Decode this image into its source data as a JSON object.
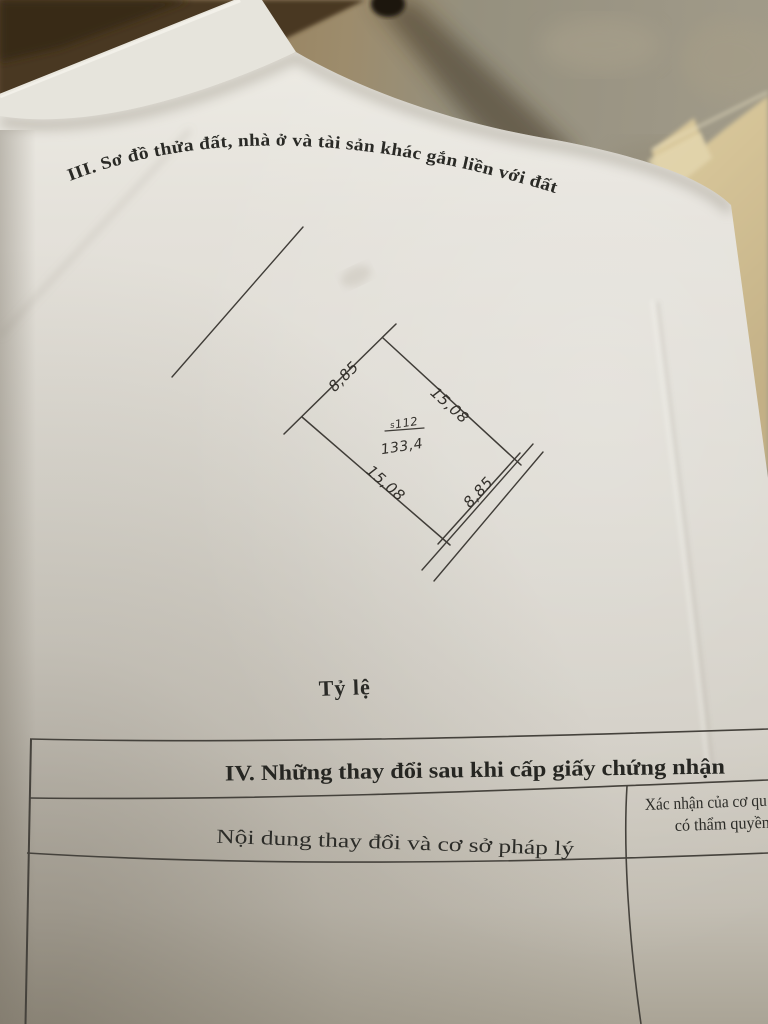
{
  "colors": {
    "ink": "#2a2a26",
    "pen_line": "#403d38",
    "paper": "#dcd9d1",
    "folder_tan": "#97825f",
    "wood_brown": "#4a3722",
    "loose_paper_cream": "#d5c49a"
  },
  "page": {
    "section_iii_heading": "III. Sơ đồ thửa đất, nhà ở và tài sản khác gắn liền với đất",
    "diagram": {
      "parcel_mark": "s",
      "parcel_number": "112",
      "area": "133,4",
      "side_top_left": "8,85",
      "side_top_right": "15,08",
      "side_bottom_left": "15,08",
      "side_bottom_right": "8,85"
    },
    "scale_label": "Tỷ lệ",
    "section_iv": {
      "heading": "IV. Những thay đổi sau khi cấp giấy chứng nhận",
      "left_column_header": "Nội dung thay đổi và cơ sở pháp lý",
      "right_column_header_line1": "Xác nhận của cơ qu",
      "right_column_header_line2": "có thẩm quyền"
    }
  }
}
